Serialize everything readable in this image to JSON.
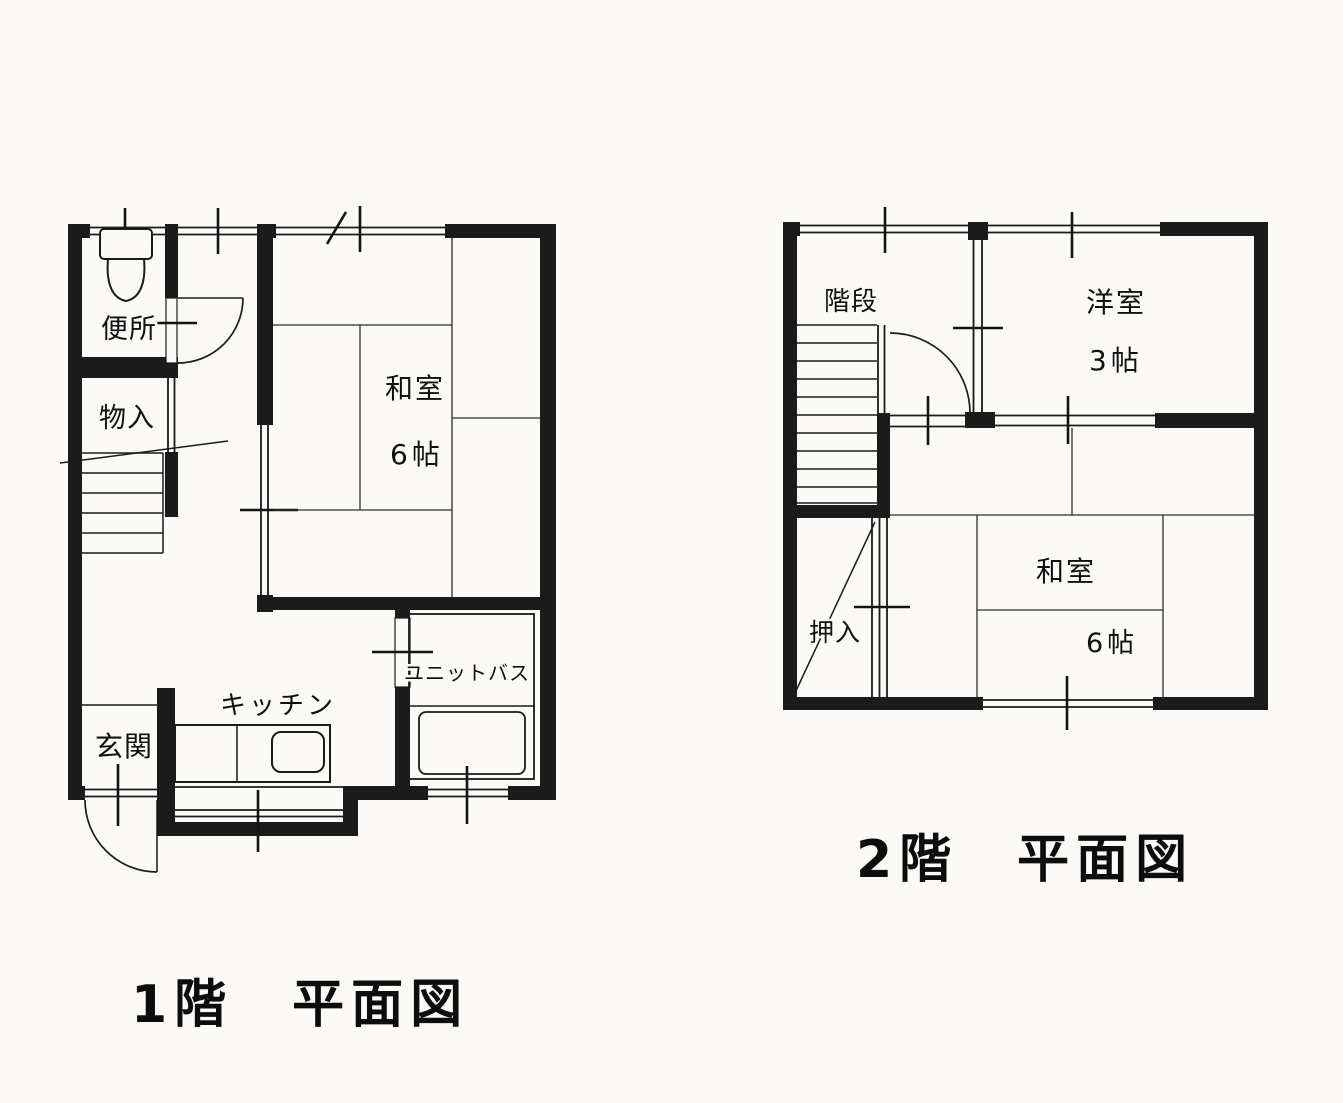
{
  "page": {
    "type": "scanned-floor-plan",
    "background_color": "#fbfaf7",
    "ink_color": "#1b1b1b"
  },
  "floor1": {
    "title": "1階　平面図",
    "rooms": {
      "toilet": {
        "label": "便所"
      },
      "storage": {
        "label": "物入"
      },
      "washitsu": {
        "label": "和室",
        "size": "6帖"
      },
      "kitchen": {
        "label": "キッチン"
      },
      "entrance": {
        "label": "玄関"
      },
      "bath": {
        "label": "ユニットバス"
      }
    }
  },
  "floor2": {
    "title": "2階　平面図",
    "rooms": {
      "stairs": {
        "label": "階段"
      },
      "western_room": {
        "label": "洋室",
        "size": "3帖"
      },
      "washitsu": {
        "label": "和室",
        "size": "6帖"
      },
      "closet": {
        "label": "押入"
      }
    }
  }
}
